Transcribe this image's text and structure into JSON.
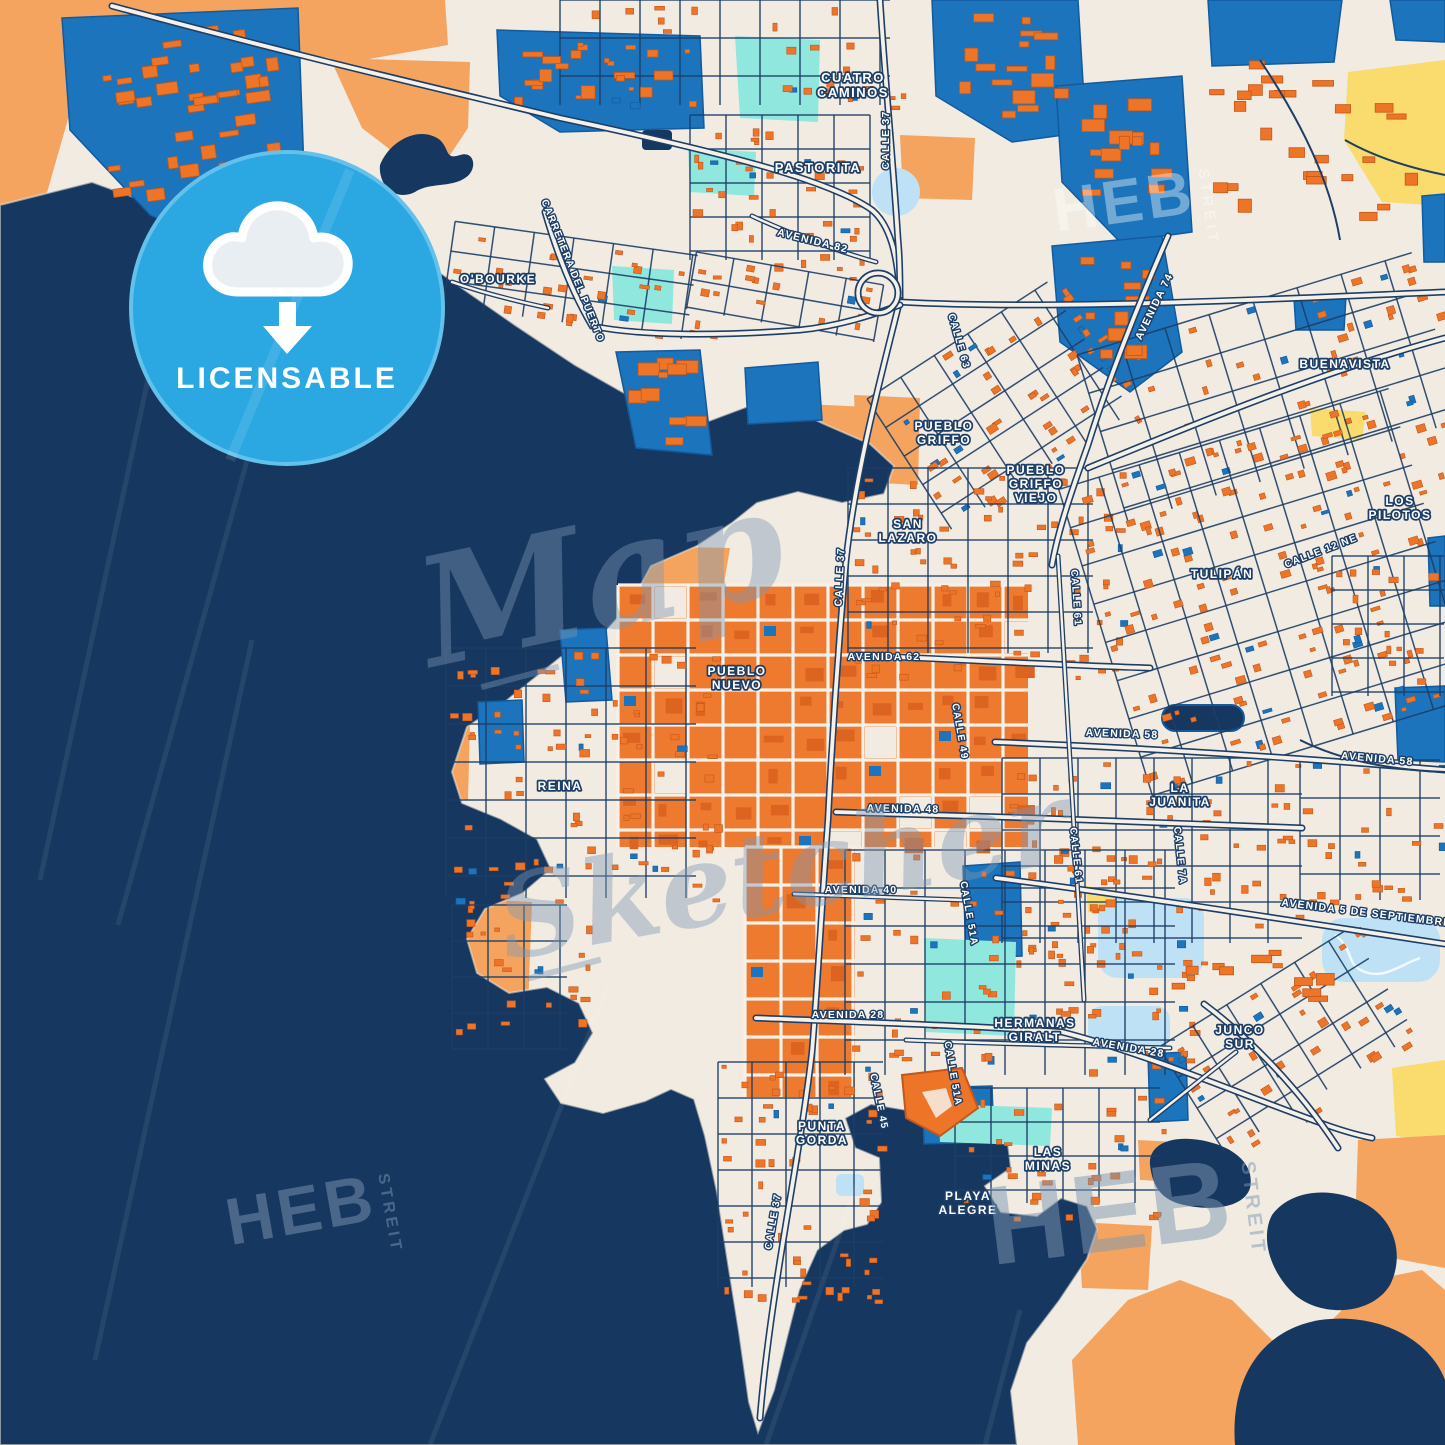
{
  "map": {
    "city_labels": [
      {
        "id": "cuatro-caminos",
        "lines": [
          "CUATRO",
          "CAMINOS"
        ],
        "x": 853,
        "y": 82,
        "s": 13,
        "r": 0
      },
      {
        "id": "pastorita",
        "lines": [
          "PASTORITA"
        ],
        "x": 818,
        "y": 172,
        "s": 13,
        "r": 0
      },
      {
        "id": "obourke",
        "lines": [
          "O'BOURKE"
        ],
        "x": 498,
        "y": 283,
        "s": 12,
        "r": 0
      },
      {
        "id": "pueblo-griffo",
        "lines": [
          "PUEBLO",
          "GRIFFO"
        ],
        "x": 944,
        "y": 430,
        "s": 12,
        "r": 0
      },
      {
        "id": "buenavista",
        "lines": [
          "BUENAVISTA"
        ],
        "x": 1345,
        "y": 368,
        "s": 12,
        "r": 0
      },
      {
        "id": "pueblo-griffo-viejo",
        "lines": [
          "PUEBLO",
          "GRIFFO",
          "VIEJO"
        ],
        "x": 1036,
        "y": 474,
        "s": 12,
        "r": 0
      },
      {
        "id": "san-lazaro",
        "lines": [
          "SAN",
          "LAZARO"
        ],
        "x": 908,
        "y": 528,
        "s": 12,
        "r": 0
      },
      {
        "id": "los-pilotos",
        "lines": [
          "LOS",
          "PILOTOS"
        ],
        "x": 1400,
        "y": 505,
        "s": 12,
        "r": 0
      },
      {
        "id": "tulipan",
        "lines": [
          "TULIPÁN"
        ],
        "x": 1222,
        "y": 578,
        "s": 12,
        "r": 0
      },
      {
        "id": "pueblo-nuevo",
        "lines": [
          "PUEBLO",
          "NUEVO"
        ],
        "x": 737,
        "y": 675,
        "s": 12,
        "r": 0
      },
      {
        "id": "reina",
        "lines": [
          "REINA"
        ],
        "x": 560,
        "y": 790,
        "s": 12,
        "r": 0
      },
      {
        "id": "la-juanita",
        "lines": [
          "LA",
          "JUANITA"
        ],
        "x": 1180,
        "y": 792,
        "s": 12,
        "r": 0
      },
      {
        "id": "hermanas-giralt",
        "lines": [
          "HERMANAS",
          "GIRALT"
        ],
        "x": 1035,
        "y": 1027,
        "s": 12,
        "r": 0
      },
      {
        "id": "junco-sur",
        "lines": [
          "JUNCO",
          "SUR"
        ],
        "x": 1240,
        "y": 1034,
        "s": 12,
        "r": 0
      },
      {
        "id": "punta-gorda",
        "lines": [
          "PUNTA",
          "GORDA"
        ],
        "x": 822,
        "y": 1130,
        "s": 12,
        "r": 0
      },
      {
        "id": "las-minas",
        "lines": [
          "LAS",
          "MINAS"
        ],
        "x": 1048,
        "y": 1156,
        "s": 12,
        "r": 0
      },
      {
        "id": "playa-alegre",
        "lines": [
          "PLAYA",
          "ALEGRE"
        ],
        "x": 968,
        "y": 1200,
        "s": 12,
        "r": 0
      }
    ],
    "road_labels": [
      {
        "id": "calle-37-n",
        "t": "CALLE 37",
        "x": 889,
        "y": 140,
        "s": 10.5,
        "r": -90
      },
      {
        "id": "avenida-82",
        "t": "AVENIDA 82",
        "x": 812,
        "y": 244,
        "s": 10.5,
        "r": 14
      },
      {
        "id": "carretera-del-puerto",
        "t": "CARRETERA DEL PUERTO",
        "x": 570,
        "y": 272,
        "s": 10,
        "r": 68
      },
      {
        "id": "avenida-74",
        "t": "AVENIDA 74",
        "x": 1157,
        "y": 308,
        "s": 10.5,
        "r": -64
      },
      {
        "id": "calle-63",
        "t": "CALLE 63",
        "x": 956,
        "y": 342,
        "s": 10,
        "r": 74
      },
      {
        "id": "calle-12-ne",
        "t": "CALLE 12 NE",
        "x": 1322,
        "y": 554,
        "s": 10,
        "r": -21
      },
      {
        "id": "avenida-62",
        "t": "AVENIDA 62",
        "x": 884,
        "y": 660,
        "s": 10.5,
        "r": 0
      },
      {
        "id": "calle-37-c",
        "t": "CALLE 37",
        "x": 843,
        "y": 577,
        "s": 10.5,
        "r": -87
      },
      {
        "id": "calle-61-n",
        "t": "CALLE 61",
        "x": 1073,
        "y": 598,
        "s": 10,
        "r": 86
      },
      {
        "id": "calle-49",
        "t": "CALLE 49",
        "x": 957,
        "y": 732,
        "s": 10,
        "r": 80
      },
      {
        "id": "avenida-58-w",
        "t": "AVENIDA 58",
        "x": 1122,
        "y": 737,
        "s": 10.5,
        "r": 2
      },
      {
        "id": "avenida-58-e",
        "t": "AVENIDA 58",
        "x": 1377,
        "y": 762,
        "s": 10.5,
        "r": 5
      },
      {
        "id": "avenida-48",
        "t": "AVENIDA 48",
        "x": 903,
        "y": 812,
        "s": 10.5,
        "r": 1
      },
      {
        "id": "calle-61-s",
        "t": "CALLE 61",
        "x": 1073,
        "y": 856,
        "s": 10,
        "r": 84
      },
      {
        "id": "calle-7a",
        "t": "CALLE 7A",
        "x": 1177,
        "y": 856,
        "s": 10,
        "r": 84
      },
      {
        "id": "avenida-40",
        "t": "AVENIDA 40",
        "x": 861,
        "y": 893,
        "s": 10.5,
        "r": 0
      },
      {
        "id": "calle-51a-n",
        "t": "CALLE 51A",
        "x": 966,
        "y": 914,
        "s": 10,
        "r": 80
      },
      {
        "id": "avenida-5-de-septiembre",
        "t": "AVENIDA 5 DE SEPTIEMBRE",
        "x": 1366,
        "y": 916,
        "s": 10.5,
        "r": 7
      },
      {
        "id": "avenida-28-w",
        "t": "AVENIDA 28",
        "x": 848,
        "y": 1018,
        "s": 10.5,
        "r": 0
      },
      {
        "id": "avenida-28-e",
        "t": "AVENIDA 28",
        "x": 1128,
        "y": 1051,
        "s": 10.5,
        "r": 10
      },
      {
        "id": "calle-51a-s",
        "t": "CALLE 51A",
        "x": 950,
        "y": 1074,
        "s": 10,
        "r": 80
      },
      {
        "id": "calle-45",
        "t": "CALLE 45",
        "x": 876,
        "y": 1102,
        "s": 10,
        "r": 78
      },
      {
        "id": "calle-37-s",
        "t": "CALLE 37",
        "x": 776,
        "y": 1222,
        "s": 10,
        "r": -80
      }
    ]
  },
  "badge": {
    "label": "LICENSABLE"
  },
  "watermarks": {
    "brand": "HEB",
    "brand_sub": "STREIT",
    "script_line1": "Map",
    "script_line2": "Sketcher"
  },
  "colors": {
    "water": "#16375F",
    "land": "#F1EBE1",
    "terrain_orange": "#F4A45F",
    "yellow": "#F9DC6D",
    "urban_blue": "#1B74BC",
    "urban_blue_dark": "#135A9E",
    "cyan": "#8FE7DE",
    "light_blue": "#BEE1F6",
    "building_orange": "#EE7428",
    "building_orange_dark": "#D25D1E",
    "road_minor": "#1D3E66",
    "road_major_fill": "#F6F1E8",
    "label_text": "#FFFFFF",
    "label_halo": "#1D3E66",
    "badge_blue": "#2BA7E2",
    "watermark_slate": "#7E98B4"
  }
}
